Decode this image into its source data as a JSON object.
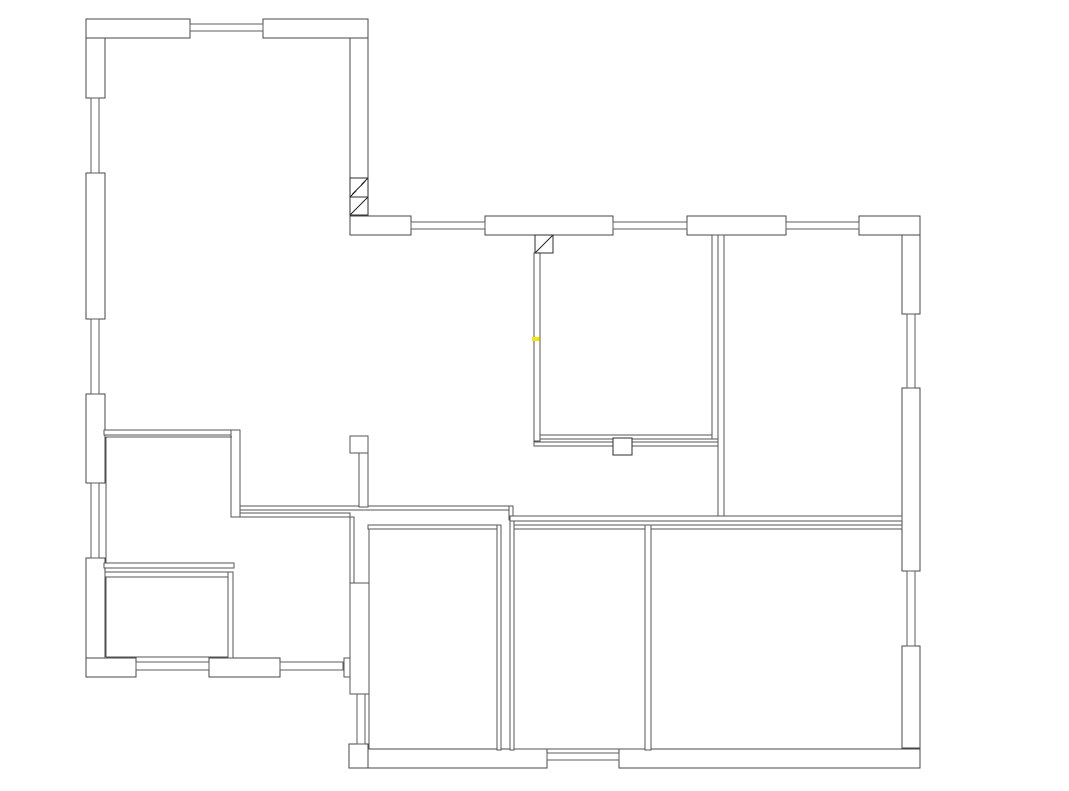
{
  "page": {
    "width": 1069,
    "height": 791,
    "background": "#ffffff"
  },
  "floorplan": {
    "colors": {
      "exterior_stroke": "#474747",
      "interior_stroke": "#565656",
      "window_stroke": "#5c5c5c",
      "door_stroke": "#2d2d2d",
      "fill": "#ffffff",
      "highlight": "#f2e40c"
    },
    "exterior_walls": [
      {
        "x": 86,
        "y": 19,
        "w": 104,
        "h": 19
      },
      {
        "x": 263,
        "y": 19,
        "w": 105,
        "h": 19
      },
      {
        "x": 86,
        "y": 38,
        "w": 19,
        "h": 60
      },
      {
        "x": 86,
        "y": 173,
        "w": 19,
        "h": 146
      },
      {
        "x": 86,
        "y": 394,
        "w": 19,
        "h": 89
      },
      {
        "x": 86,
        "y": 558,
        "w": 19,
        "h": 100
      },
      {
        "x": 86,
        "y": 658,
        "w": 50,
        "h": 19
      },
      {
        "x": 209,
        "y": 658,
        "w": 71,
        "h": 19
      },
      {
        "x": 350,
        "y": 38,
        "w": 18,
        "h": 140
      },
      {
        "x": 350,
        "y": 216,
        "w": 61,
        "h": 19
      },
      {
        "x": 485,
        "y": 216,
        "w": 128,
        "h": 19
      },
      {
        "x": 687,
        "y": 216,
        "w": 99,
        "h": 19
      },
      {
        "x": 859,
        "y": 216,
        "w": 61,
        "h": 19
      },
      {
        "x": 902,
        "y": 235,
        "w": 18,
        "h": 79
      },
      {
        "x": 902,
        "y": 388,
        "w": 18,
        "h": 183
      },
      {
        "x": 902,
        "y": 646,
        "w": 18,
        "h": 102
      },
      {
        "x": 619,
        "y": 749,
        "w": 301,
        "h": 19
      },
      {
        "x": 349,
        "y": 744,
        "w": 19,
        "h": 24
      },
      {
        "x": 368,
        "y": 749,
        "w": 179,
        "h": 19
      }
    ],
    "windows": [
      {
        "x": 190,
        "y": 24,
        "w": 73,
        "h": 7
      },
      {
        "x": 91,
        "y": 98,
        "w": 8,
        "h": 75
      },
      {
        "x": 91,
        "y": 319,
        "w": 8,
        "h": 75
      },
      {
        "x": 91,
        "y": 483,
        "w": 8,
        "h": 75
      },
      {
        "x": 136,
        "y": 662,
        "w": 73,
        "h": 8
      },
      {
        "x": 280,
        "y": 662,
        "w": 63,
        "h": 8
      },
      {
        "x": 411,
        "y": 222,
        "w": 74,
        "h": 7
      },
      {
        "x": 613,
        "y": 222,
        "w": 74,
        "h": 7
      },
      {
        "x": 786,
        "y": 222,
        "w": 73,
        "h": 7
      },
      {
        "x": 907,
        "y": 314,
        "w": 8,
        "h": 74
      },
      {
        "x": 907,
        "y": 571,
        "w": 8,
        "h": 75
      },
      {
        "x": 547,
        "y": 753,
        "w": 72,
        "h": 7
      },
      {
        "x": 357,
        "y": 692,
        "w": 8,
        "h": 52
      }
    ],
    "interior_walls": [
      {
        "x": 104,
        "y": 430,
        "w": 136,
        "h": 5
      },
      {
        "x": 231,
        "y": 430,
        "w": 9,
        "h": 87
      },
      {
        "x": 104,
        "y": 563,
        "w": 130,
        "h": 5
      },
      {
        "x": 105,
        "y": 572,
        "w": 128,
        "h": 5
      },
      {
        "x": 228,
        "y": 572,
        "w": 5,
        "h": 86
      },
      {
        "x": 240,
        "y": 506,
        "w": 270,
        "h": 4
      },
      {
        "x": 240,
        "y": 513,
        "w": 110,
        "h": 4
      },
      {
        "x": 350,
        "y": 517,
        "w": 4,
        "h": 66
      },
      {
        "x": 509,
        "y": 506,
        "w": 4,
        "h": 14
      },
      {
        "x": 510,
        "y": 516,
        "w": 392,
        "h": 5
      },
      {
        "x": 350,
        "y": 436,
        "w": 18,
        "h": 17
      },
      {
        "x": 359,
        "y": 453,
        "w": 9,
        "h": 54
      },
      {
        "x": 350,
        "y": 583,
        "w": 19,
        "h": 111
      },
      {
        "x": 344,
        "y": 658,
        "w": 6,
        "h": 19
      },
      {
        "x": 368,
        "y": 525,
        "w": 133,
        "h": 4
      },
      {
        "x": 497,
        "y": 525,
        "w": 4,
        "h": 225
      },
      {
        "x": 510,
        "y": 521,
        "w": 4,
        "h": 229
      },
      {
        "x": 514,
        "y": 525,
        "w": 131,
        "h": 4
      },
      {
        "x": 645,
        "y": 525,
        "w": 6,
        "h": 225
      },
      {
        "x": 651,
        "y": 525,
        "w": 251,
        "h": 4
      },
      {
        "x": 534,
        "y": 253,
        "w": 6,
        "h": 188
      },
      {
        "x": 540,
        "y": 435,
        "w": 172,
        "h": 4
      },
      {
        "x": 534,
        "y": 442,
        "w": 184,
        "h": 4
      },
      {
        "x": 712,
        "y": 235,
        "w": 6,
        "h": 204
      },
      {
        "x": 718,
        "y": 235,
        "w": 6,
        "h": 281
      }
    ],
    "inner_lines": [
      {
        "x1": 106,
        "y1": 437,
        "x2": 232,
        "y2": 437
      },
      {
        "x1": 106,
        "y1": 437,
        "x2": 106,
        "y2": 563
      },
      {
        "x1": 106,
        "y1": 577,
        "x2": 106,
        "y2": 657
      },
      {
        "x1": 106,
        "y1": 657,
        "x2": 228,
        "y2": 657
      },
      {
        "x1": 369,
        "y1": 529,
        "x2": 369,
        "y2": 749
      },
      {
        "x1": 514,
        "y1": 749,
        "x2": 645,
        "y2": 749
      }
    ],
    "door_squares": [
      {
        "x": 535,
        "y": 235,
        "w": 18,
        "h": 18,
        "diagonal": true
      },
      {
        "x": 350,
        "y": 178,
        "w": 18,
        "h": 19,
        "diagonal": true
      },
      {
        "x": 350,
        "y": 197,
        "w": 18,
        "h": 18,
        "diagonal": true
      },
      {
        "x": 613,
        "y": 438,
        "w": 19,
        "h": 17,
        "diagonal": false
      }
    ],
    "highlight_mark": {
      "x": 532,
      "y": 337,
      "w": 7,
      "h": 4
    }
  }
}
